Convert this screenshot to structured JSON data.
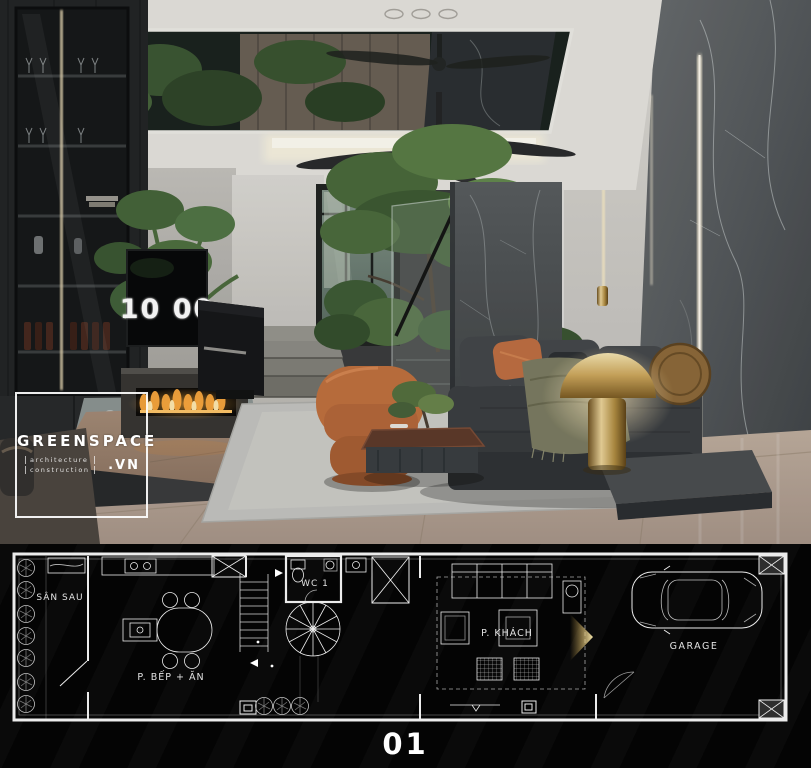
{
  "brand": {
    "name": "GREENSPACE",
    "tagline_line1": "architecture",
    "tagline_line2": "construction",
    "domain_suffix": ".VN"
  },
  "scene": {
    "clock_display": "10 00"
  },
  "floor_plan": {
    "page_number": "01",
    "rooms": {
      "backyard": "SÂN SAU",
      "kitchen_dining": "P. BẾP + ĂN",
      "wc": "WC 1",
      "living_room": "P. KHÁCH",
      "garage": "GARAGE"
    }
  },
  "colors": {
    "accent_orange": "#bf6f43",
    "brass_gold": "#c9a24b",
    "flame_orange": "#ff9a2e",
    "marble_gray": "#54585a",
    "plan_line": "#e8e8e8",
    "camera_cone_gold": "#e8d28a",
    "rug_gray": "#c6c6c2"
  }
}
